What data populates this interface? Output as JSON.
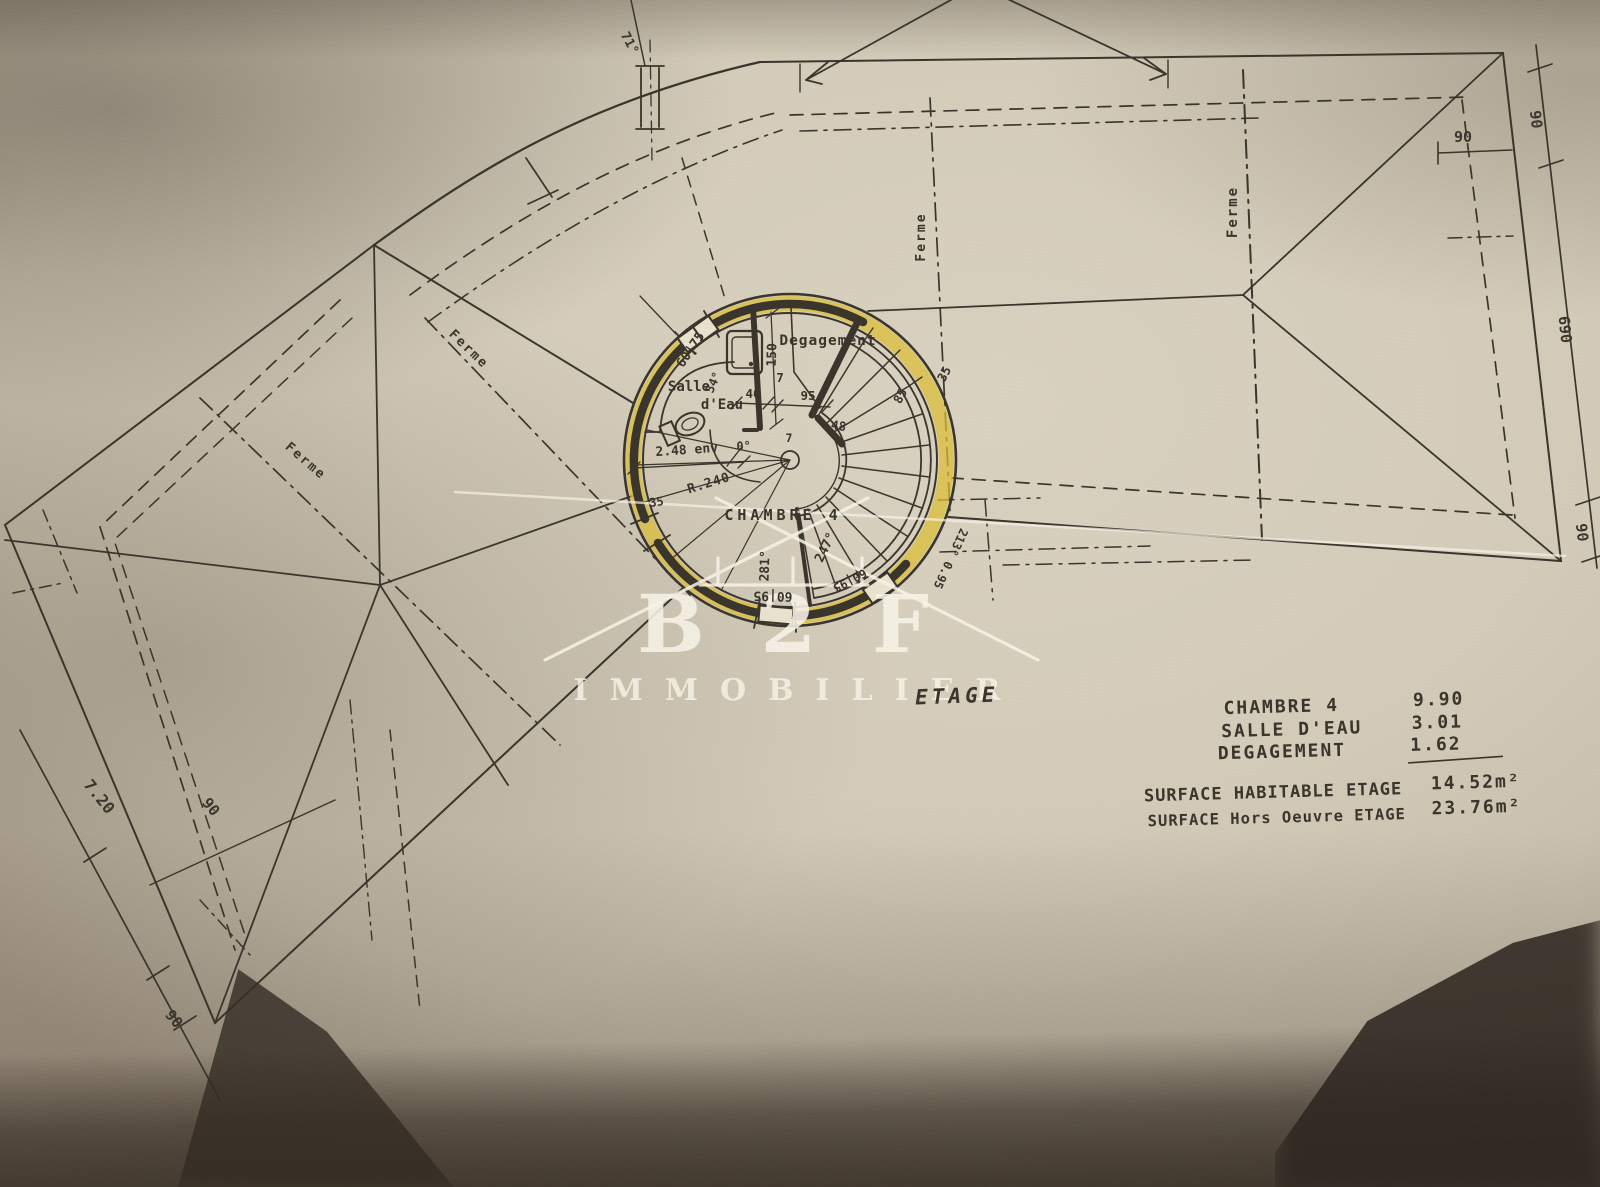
{
  "watermark": {
    "brand": "B 2 F",
    "subtitle": "IMMOBILIER"
  },
  "plan": {
    "floor_label": "ETAGE",
    "rooms": {
      "chambre": "CHAMBRE 4",
      "salle_line1": "Salle",
      "salle_line2": "d'Eau",
      "degagement": "Degagement"
    },
    "ferme": [
      "Ferme",
      "Ferme",
      "Ferme",
      "Ferme"
    ],
    "dims": {
      "chimney_angle": "71°",
      "right_top": "90",
      "right_mid": "690",
      "right_low": "90",
      "right_inner": "90",
      "left_run": "7.20",
      "left_w1": "90",
      "left_w2": "90",
      "win_tl": "60|75",
      "angle_tl": "54°",
      "d150": "150",
      "d40": "40",
      "d7a": "7",
      "d7b": "7",
      "d95": "95",
      "d48": "48",
      "d85": "85",
      "d35_out": "35",
      "d248": "2.48 env",
      "d0": "0°",
      "radius": "R.240",
      "d35_in": "35",
      "a281": "281°",
      "a247": "247°",
      "win_bot": "60|95",
      "win_br": "60|95",
      "door_br": "213° 0.95"
    }
  },
  "table": {
    "rows": [
      {
        "label": "CHAMBRE 4",
        "value": "9.90"
      },
      {
        "label": "SALLE D'EAU",
        "value": "3.01"
      },
      {
        "label": "DEGAGEMENT",
        "value": "1.62"
      }
    ],
    "totals": [
      {
        "label": "SURFACE HABITABLE ETAGE",
        "value": "14.52m²"
      },
      {
        "label": "SURFACE Hors Oeuvre ETAGE",
        "value": "23.76m²"
      }
    ]
  }
}
